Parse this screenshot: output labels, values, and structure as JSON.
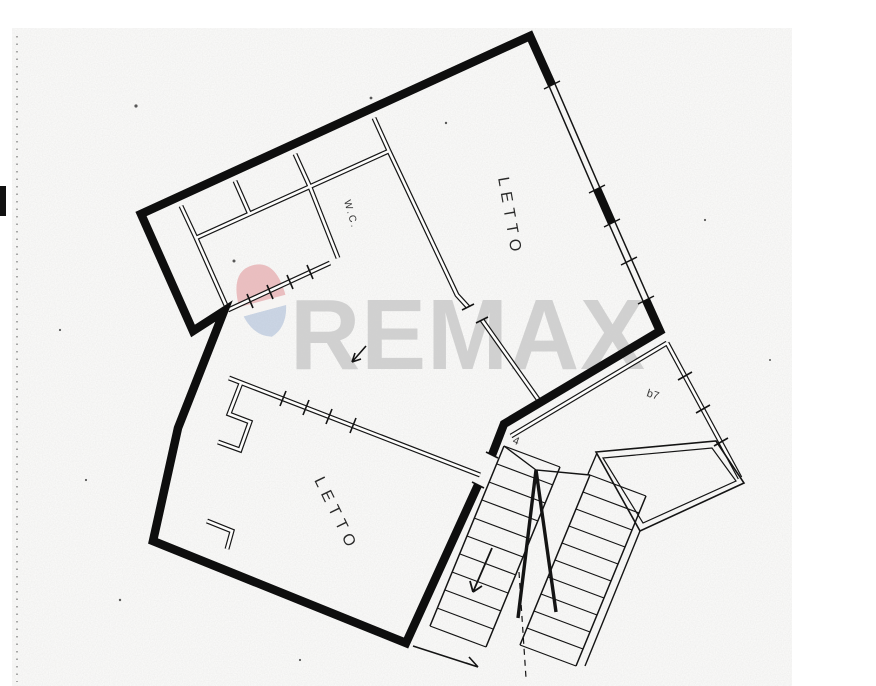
{
  "watermark": {
    "brand": "REMAX"
  },
  "rooms": {
    "letto_right": "LETTO",
    "letto_left": "LETTO",
    "wc": "W.C."
  },
  "annotations": {
    "landing_number": "4",
    "balcony_code": "b7"
  },
  "colors": {
    "ink": "#141414",
    "paper": "#ffffff",
    "watermark_gray": "#c9c9c9",
    "balloon_red": "#e8b5b7",
    "balloon_blue": "#9fb3d2"
  }
}
